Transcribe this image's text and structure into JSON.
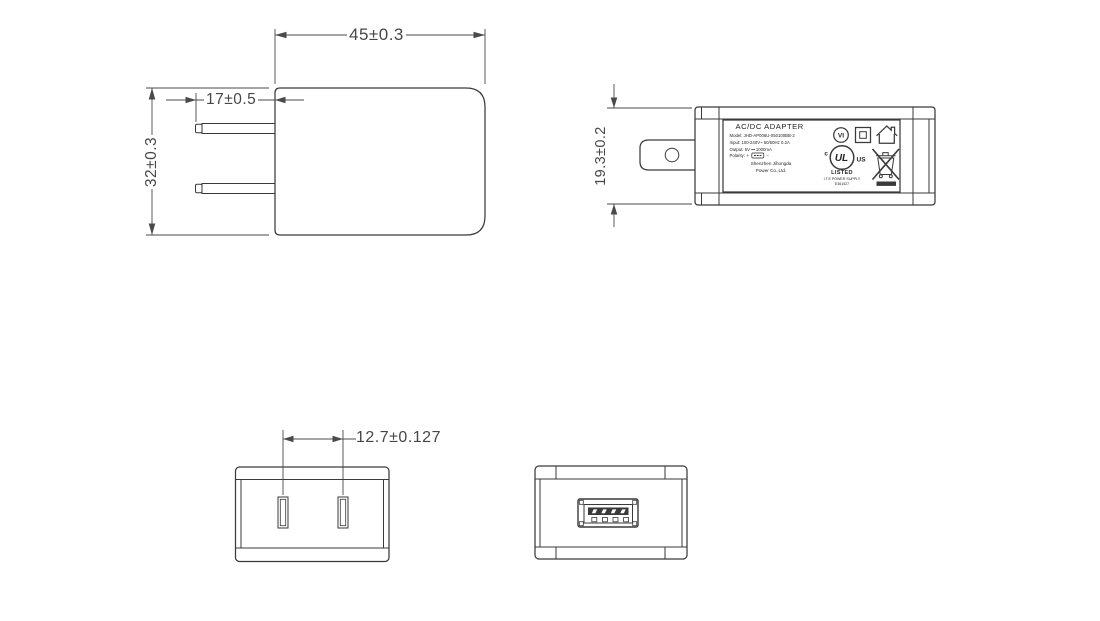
{
  "views": {
    "side": {
      "dim_width": "45±0.3",
      "dim_prong": "17±0.5",
      "dim_height": "32±0.3"
    },
    "front": {
      "dim_thickness": "19.3±0.2"
    },
    "bottom": {
      "dim_spacing": "12.7±0.127"
    },
    "label": {
      "title": "AC/DC  ADAPTER",
      "model": "Model: JHD-AP006U-050100BB-2",
      "input": "Input: 100-240V~ 50/60Hz 0.2A",
      "output": "Output: 5V ⎓ 1000mA",
      "polarity": "Polarity:",
      "plus": "+",
      "minus": "−",
      "company1": "Shenzhen Jihongda",
      "company2": "Power Co.,Ltd.",
      "vi": "VI",
      "ul": "UL",
      "ul_c": "c",
      "ul_us": "US",
      "listed": "LISTED",
      "supply": "I.T.E POWER SUPPLY",
      "file_no": "E361527"
    }
  },
  "icons": {
    "efficiency_mark": "vi-circle-icon",
    "class2": "double-square-insulation-icon",
    "indoor": "house-indoor-use-icon",
    "ul": "ul-listed-icon",
    "weee": "crossed-out-bin-icon",
    "usb_port": "usb-a-port",
    "polarity_connector": "usb-polarity-icon"
  },
  "colors": {
    "line": "#3a3a3a",
    "background": "#ffffff"
  }
}
